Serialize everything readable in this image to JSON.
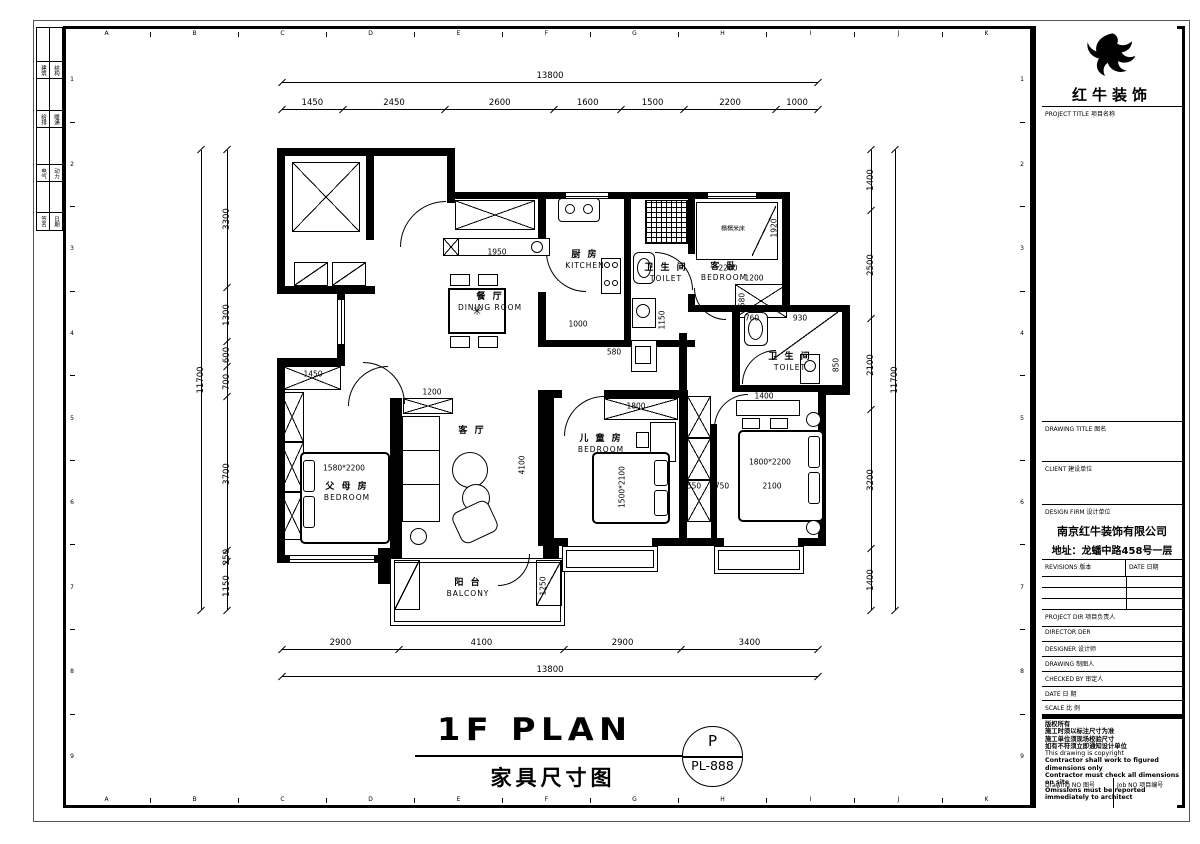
{
  "sheet": {
    "grid_letters": [
      "A",
      "B",
      "C",
      "D",
      "E",
      "F",
      "G",
      "H",
      "I",
      "J",
      "K"
    ],
    "grid_numbers": [
      "1",
      "2",
      "3",
      "4",
      "5",
      "6",
      "7",
      "8",
      "9"
    ],
    "sign_rows": [
      [
        "建筑",
        "结构"
      ],
      [
        "给排",
        "暖通"
      ],
      [
        "电气",
        "动力"
      ],
      [
        "签名",
        "日期"
      ]
    ]
  },
  "titleblock": {
    "brand": "红牛装饰",
    "project_title": "PROJECT TITLE  项目名称",
    "drawing_title": "DRAWING TITLE  图名",
    "client": "CLIENT  建设单位",
    "design_firm": "DESIGN FIRM  设计单位",
    "firm_name": "南京红牛装饰有限公司",
    "firm_address": "地址：龙蟠中路458号一层",
    "revisions": "REVISIONS  版本",
    "rev_date": "DATE  日期",
    "project_dir": "PROJECT DIR  项目负责人",
    "director": "DIRECTOR DER",
    "designer": "DESIGNER  设计师",
    "drawing_by": "DRAWING  制图人",
    "checked_by": "CHECKED BY  审定人",
    "date": "DATE  日 期",
    "scale": "SCALE  比 例",
    "copyright": [
      "版权所有",
      "施工时须以标注尺寸为准",
      "施工单位须现场校验尺寸",
      "如有不符须立即通知设计单位",
      "This drawing is copyright",
      "Contractor shall work to figured dimensions only",
      "Contractor must check all dimensions on site",
      "Omissions must be reported immediately to architect"
    ],
    "drawing_no": "Drawing NO  图号",
    "job_no": "Job NO  项目编号"
  },
  "plan": {
    "title_en": "1F PLAN",
    "title_cn": "家具尺寸图",
    "stamp_letter": "P",
    "stamp_code": "PL-888",
    "rooms": {
      "dining_cn": "餐 厅",
      "dining_en": "DINING ROOM",
      "kitchen_cn": "厨 房",
      "kitchen_en": "KITCHEN",
      "toilet1_cn": "卫 生 间",
      "toilet1_en": "TOILET",
      "guest_cn": "客 卧",
      "guest_en": "BEDROOM",
      "toilet2_cn": "卫 生 间",
      "toilet2_en": "TOILET",
      "living_cn": "客 厅",
      "kids_cn": "儿 童 房",
      "kids_en": "BEDROOM",
      "parents_cn": "父 母 房",
      "parents_en": "BEDROOM",
      "balcony_cn": "阳 台",
      "balcony_en": "BALCONY",
      "tatami": "榻榻米床",
      "bed_parents": "1580*2200",
      "bed_kids": "1500*2100",
      "bed_master": "1800*2200"
    },
    "dims": {
      "top_total": "13800",
      "top": [
        "1450",
        "2450",
        "2600",
        "1600",
        "1500",
        "2200",
        "1000"
      ],
      "bottom": [
        "2900",
        "4100",
        "2900",
        "3400"
      ],
      "bottom_total": "13800",
      "left_total": "11700",
      "left": [
        "3300",
        "1300",
        "600",
        "700",
        "3700",
        "250",
        "1150"
      ],
      "right": [
        "1400",
        "2500",
        "2100",
        "3200",
        "1400"
      ],
      "right_total": "11700",
      "inner": [
        "1950",
        "1000",
        "580",
        "960",
        "1150",
        "2200",
        "1200",
        "1920",
        "580",
        "760",
        "930",
        "850",
        "1400",
        "550",
        "750",
        "2100",
        "1800",
        "1200",
        "3500",
        "4100",
        "1250",
        "1450"
      ]
    }
  }
}
